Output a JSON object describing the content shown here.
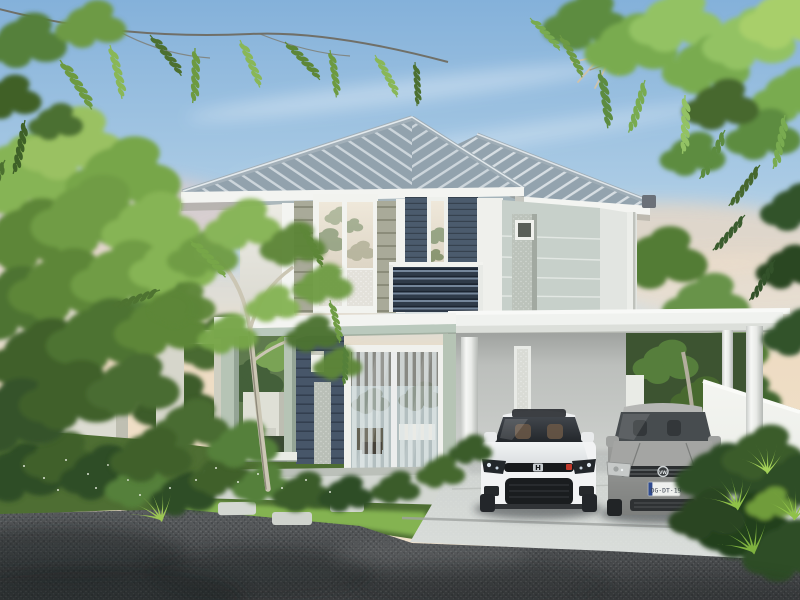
{
  "meta": {
    "type": "architectural-rendering",
    "description": "3D exterior rendering of a modern two-story house at dusk with a carport, two parked cars, tropical garden, white fences and an asphalt street in the foreground"
  },
  "scene": {
    "sky": {
      "label": "dusk sky with wispy clouds",
      "top_color": "#84b1da",
      "horizon_color": "#eedcc3"
    },
    "house": {
      "label": "two-story modern house",
      "roof": {
        "style": "hipped tile roof",
        "color": "#93a3ae"
      },
      "upper_floor": {
        "siding_color": "#a9aa99",
        "accent_panel_color": "#4b5b6d",
        "features": [
          "large white-framed window",
          "tall narrow window",
          "dark louvered balcony railing"
        ]
      },
      "lower_floor": {
        "wall_color": "#475669",
        "features": [
          "covered porch with sage-green columns",
          "sliding glass door with sheer curtains",
          "wall lamp",
          "stone planter strip"
        ]
      },
      "right_wing": {
        "wall_color": "#c7d0ca",
        "features": [
          "small vent window",
          "textured stone pillar",
          "downpipe"
        ]
      }
    },
    "carport": {
      "label": "flat-roof white carport",
      "columns": 3,
      "features": [
        "frosted light panel on back wall"
      ]
    },
    "vehicles": [
      {
        "name": "white coupe",
        "position": "left carport bay",
        "body_color": "#f2f3f4",
        "brand_badge": "H",
        "accent": "red badge"
      },
      {
        "name": "silver hatchback",
        "position": "right carport bay",
        "body_color": "#9d9e9c",
        "brand_badge": "VW",
        "license_plate": "DG·DT·19"
      }
    ],
    "garden": {
      "left": [
        "tall feathery trees",
        "pale-trunk tree",
        "white garden walls",
        "ground-cover shrubs with white flowers",
        "stepping stones"
      ],
      "right": [
        "white perimeter fence",
        "dense shrubs",
        "bright spiky plants"
      ],
      "overhanging": [
        "pinnate leaf branches top-left",
        "pinnate leaf canopy top-right",
        "dry twig"
      ]
    },
    "ground": {
      "driveway": "light concrete apron",
      "road": "dark asphalt with tree shadows",
      "lawn": "sunlit green strip"
    }
  },
  "palette": {
    "sky-top": "#84b1da",
    "sky-horizon": "#eedcc3",
    "roof": "#93a3ae",
    "roof-rib": "#e3e9ec",
    "fascia": "#f3f4f1",
    "sage-siding": "#a9aa99",
    "navy-panel": "#4b5b6d",
    "navy-ground": "#475669",
    "wing-wall": "#c7d0ca",
    "porch-sage": "#b6c4b5",
    "slab-sage": "#bac9bd",
    "carport-white": "#f0f2ef",
    "concrete": "#cdd1ce",
    "road": "#4b4e50",
    "grass": "#4e6e33",
    "grass-light": "#8abb55",
    "leaf-bright": "#86b455",
    "leaf-mid": "#5d8638",
    "leaf-dark": "#35522a",
    "car-white": "#f2f3f4",
    "car-gray": "#9d9e9c",
    "fence": "#eceee9",
    "trunk": "#cbc6b4",
    "plate-blue": "#2e4a8f"
  }
}
